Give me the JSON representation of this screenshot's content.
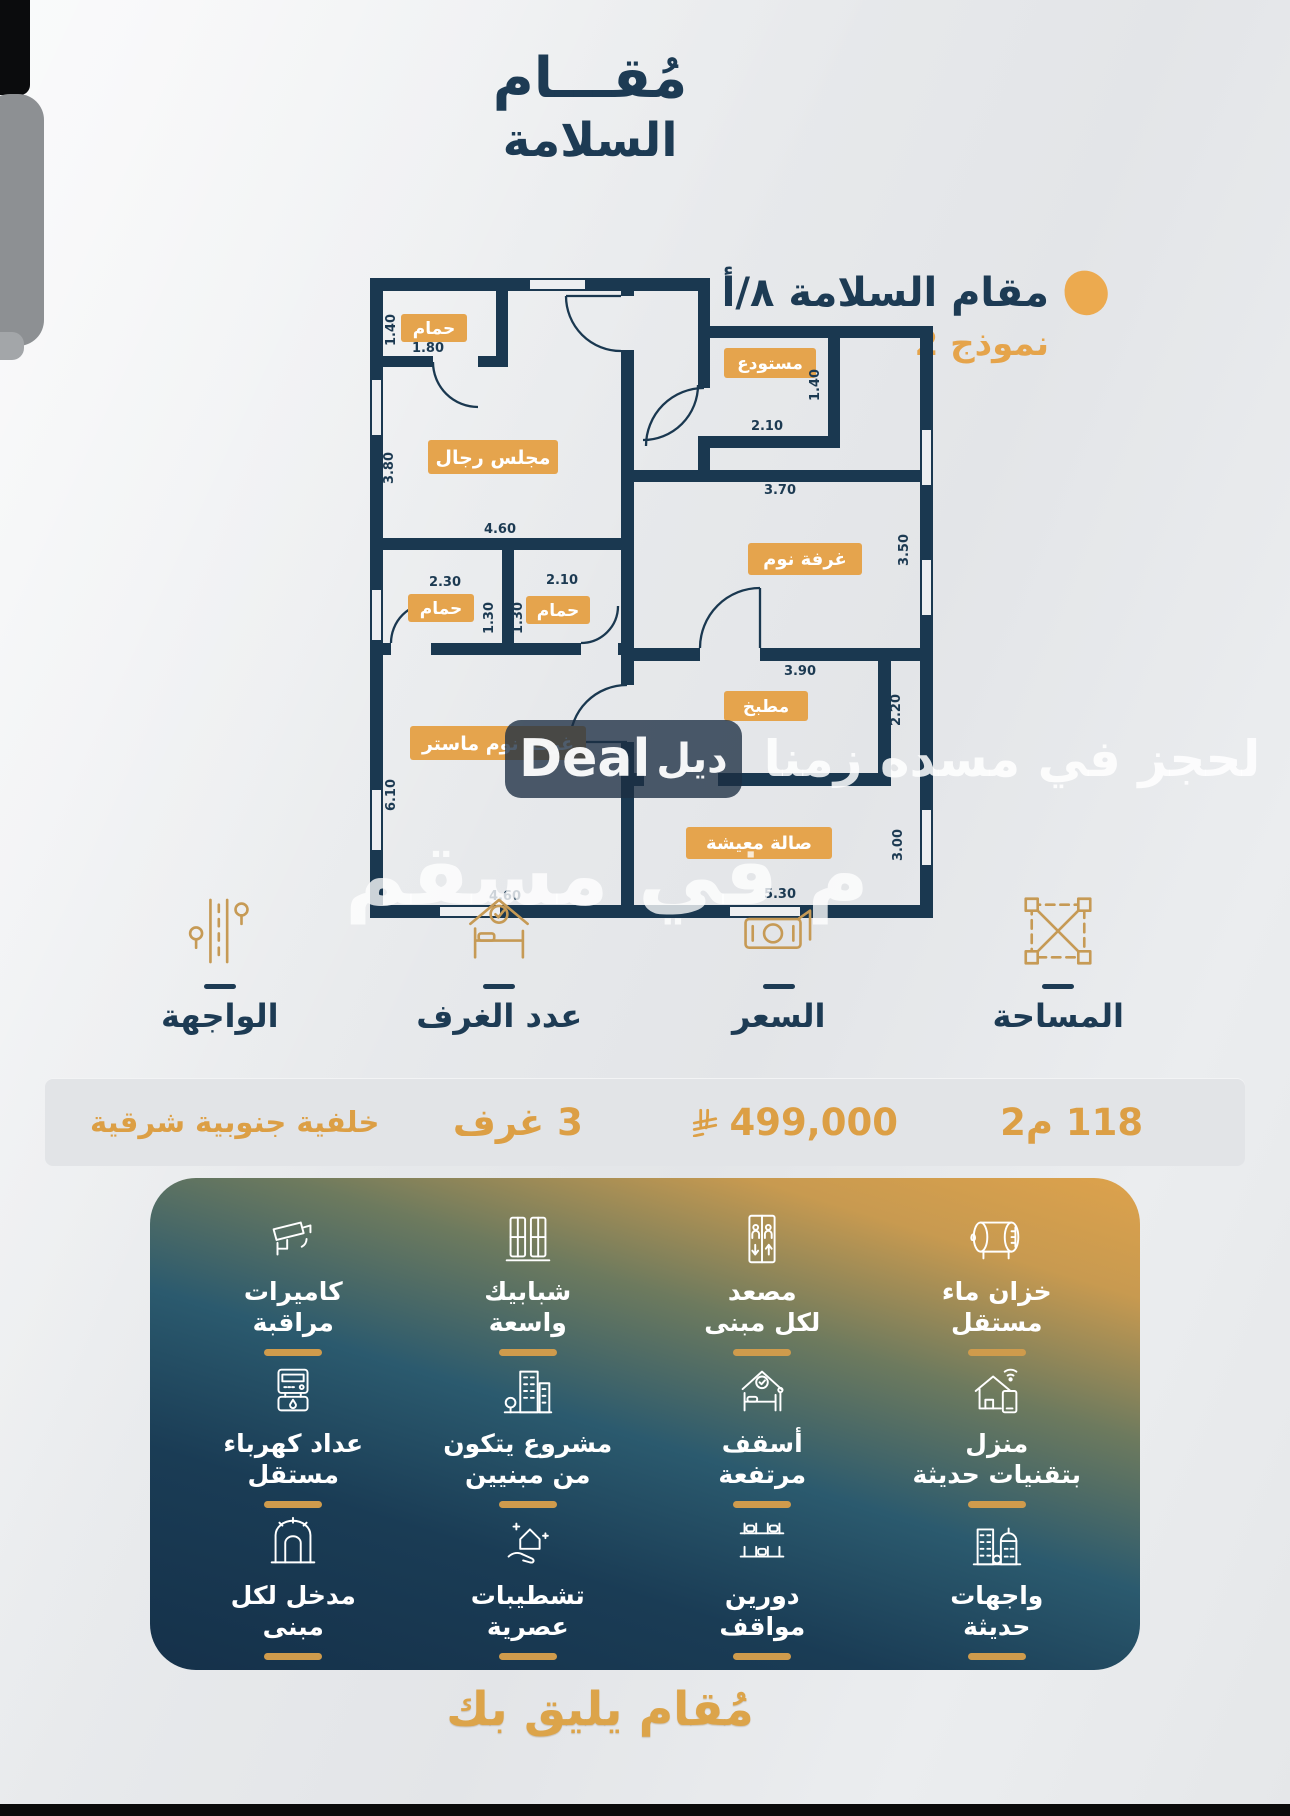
{
  "brand": {
    "logo_line1": "مُقـــام",
    "logo_line2": "السلامة",
    "tagline": "مُقام يليق بك"
  },
  "plan_header": {
    "title": "مقام السلامة ٨/أ",
    "model": "نموذج 2"
  },
  "floorplan": {
    "rooms": {
      "bath_top": "حمام",
      "majlis": "مجلس رجال",
      "storage": "مستودع",
      "bedroom": "غرفة نوم",
      "bath_left": "حمام",
      "bath_right": "حمام",
      "master": "غرفة نوم ماستر",
      "kitchen": "مطبخ",
      "living": "صالة معيشة"
    },
    "dims": {
      "bath_top_h": "1.40",
      "bath_top_w": "1.80",
      "majlis_h": "3.80",
      "majlis_w": "4.60",
      "bath_left_w": "2.30",
      "bath_left_h": "1.30",
      "bath_right_w": "2.10",
      "bath_right_h": "1.30",
      "master_h": "6.10",
      "master_w": "4.60",
      "storage_w": "2.10",
      "storage_h": "1.40",
      "bedroom_w": "3.70",
      "bedroom_h": "3.50",
      "kitchen_w": "3.90",
      "kitchen_h": "2.20",
      "living_h": "3.00",
      "living_w": "5.30"
    }
  },
  "info": {
    "area": {
      "label": "المساحة",
      "value": "118 م2"
    },
    "price": {
      "label": "السعر",
      "value": "499,000"
    },
    "rooms": {
      "label": "عدد الغرف",
      "value": "3 غرف"
    },
    "facade": {
      "label": "الواجهة",
      "value": "خلفية جنوبية شرقية"
    }
  },
  "features": [
    {
      "line1": "خزان ماء",
      "line2": "مستقل",
      "icon": "water-tank"
    },
    {
      "line1": "مصعد",
      "line2": "لكل مبنى",
      "icon": "elevator"
    },
    {
      "line1": "شبابيك",
      "line2": "واسعة",
      "icon": "windows"
    },
    {
      "line1": "كاميرات",
      "line2": "مراقبة",
      "icon": "cctv"
    },
    {
      "line1": "منزل",
      "line2": "بتقنيات حديثة",
      "icon": "smart-home"
    },
    {
      "line1": "أسقف",
      "line2": "مرتفعة",
      "icon": "high-ceiling"
    },
    {
      "line1": "مشروع يتكون",
      "line2": "من مبنيين",
      "icon": "two-buildings"
    },
    {
      "line1": "عداد كهرباء",
      "line2": "مستقل",
      "icon": "electric-meter"
    },
    {
      "line1": "واجهات",
      "line2": "حديثة",
      "icon": "modern-facades"
    },
    {
      "line1": "دورين",
      "line2": "مواقف",
      "icon": "parking"
    },
    {
      "line1": "تشطيبات",
      "line2": "عصرية",
      "icon": "finishes"
    },
    {
      "line1": "مدخل لكل",
      "line2": "مبنى",
      "icon": "entrance"
    }
  ],
  "watermark": {
    "brand_en": "Deal",
    "brand_ar": "ديل",
    "line1": "لحجز في مسده زمنا",
    "line2": "م في مسقم"
  },
  "colors": {
    "accent_gold": "#dc9f45",
    "navy": "#1d3b54",
    "wall_navy": "#1a3850",
    "room_label_orange": "#e5a44d"
  }
}
